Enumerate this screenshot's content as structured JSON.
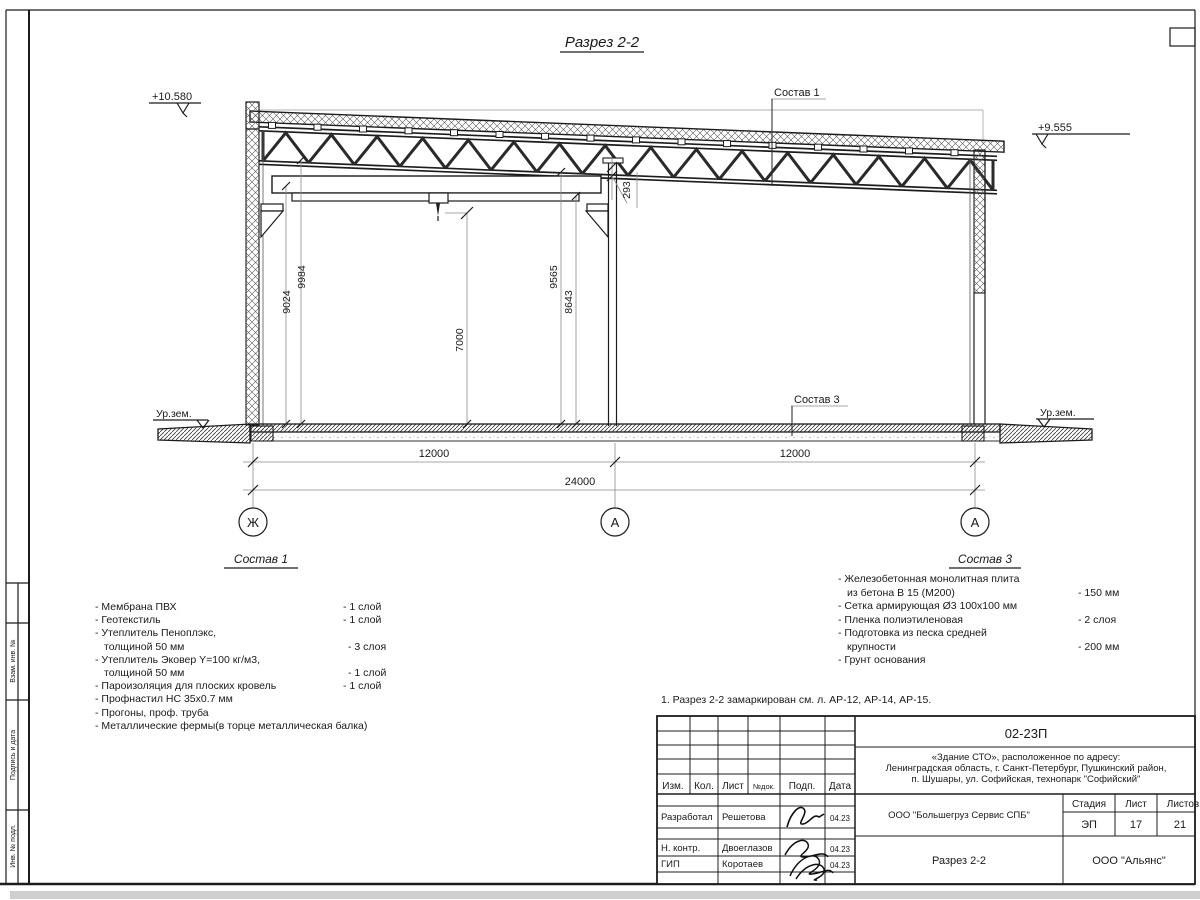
{
  "drawing": {
    "title": "Разрез 2-2",
    "elev_left": "+10.580",
    "elev_right": "+9.555",
    "ground_left": "Ур.зем.",
    "ground_right": "Ур.зем.",
    "label_sostav1": "Состав 1",
    "label_sostav3": "Состав 3",
    "dim_9024": "9024",
    "dim_9984": "9984",
    "dim_7000": "7000",
    "dim_9565": "9565",
    "dim_8643": "8643",
    "dim_293": "293",
    "dim_span_left": "12000",
    "dim_span_right": "12000",
    "dim_total": "24000",
    "axis_left": "Ж",
    "axis_mid": "А",
    "axis_right": "А"
  },
  "sostav1": {
    "heading": "Состав 1",
    "rows": [
      {
        "label": "- Мембрана ПВХ",
        "value": "- 1 слой"
      },
      {
        "label": "- Геотекстиль",
        "value": "- 1 слой"
      },
      {
        "label": "- Утеплитель Пеноплэкс,",
        "value": ""
      },
      {
        "label": "толщиной 50 мм",
        "value": "- 3 слоя"
      },
      {
        "label": "- Утеплитель Эковер Y=100 кг/м3,",
        "value": ""
      },
      {
        "label": "толщиной 50 мм",
        "value": "- 1 слой"
      },
      {
        "label": "- Пароизоляция для плоских кровель",
        "value": "- 1 слой"
      },
      {
        "label": "- Профнастил НС 35х0.7 мм",
        "value": ""
      },
      {
        "label": "- Прогоны, проф. труба",
        "value": ""
      },
      {
        "label": "- Металлические фермы(в торце металлическая балка)",
        "value": ""
      }
    ]
  },
  "sostav3": {
    "heading": "Состав 3",
    "rows": [
      {
        "label": "- Железобетонная  монолитная плита",
        "value": ""
      },
      {
        "label": "из бетона В 15 (М200)",
        "value": "- 150 мм"
      },
      {
        "label": "- Сетка армирующая Ø3 100х100 мм",
        "value": ""
      },
      {
        "label": "- Пленка полиэтиленовая",
        "value": "-  2 слоя"
      },
      {
        "label": "- Подготовка из песка средней",
        "value": ""
      },
      {
        "label": "крупности",
        "value": "- 200 мм"
      },
      {
        "label": "- Грунт основания",
        "value": ""
      }
    ]
  },
  "note": "1. Разрез 2-2 замаркирован см. л. АР-12, АР-14, АР-15.",
  "titleblock": {
    "doc_code": "02-23П",
    "project_line1": "«Здание СТО», расположенное по адресу:",
    "project_line2": "Ленинградская область, г. Санкт-Петербург, Пушкинский район,",
    "project_line3": "п. Шушары, ул. Софийская, технопарк \"Софийский\"",
    "col_izm": "Изм.",
    "col_kol": "Кол.",
    "col_list": "Лист",
    "col_ndok": "№док.",
    "col_podp": "Подп.",
    "col_data": "Дата",
    "row1_role": "Разработал",
    "row1_name": "Решетова",
    "row1_date": "04.23",
    "row2_role": "Н. контр.",
    "row2_name": "Двоеглазов",
    "row2_date": "04.23",
    "row3_role": "ГИП",
    "row3_name": "Коротаев",
    "row3_date": "04.23",
    "org": "ООО \"Большегруз Сервис СПБ\"",
    "sheet_title": "Разрез 2-2",
    "company": "ООО \"Альянс\"",
    "stage_label": "Стадия",
    "sheet_label": "Лист",
    "sheets_label": "Листов",
    "stage": "ЭП",
    "sheet_no": "17",
    "sheets_total": "21"
  },
  "frame": {
    "stamp_vzam": "Взам. инв. №",
    "stamp_podpis": "Подпись и дата",
    "stamp_inv": "Инв. № подл."
  }
}
